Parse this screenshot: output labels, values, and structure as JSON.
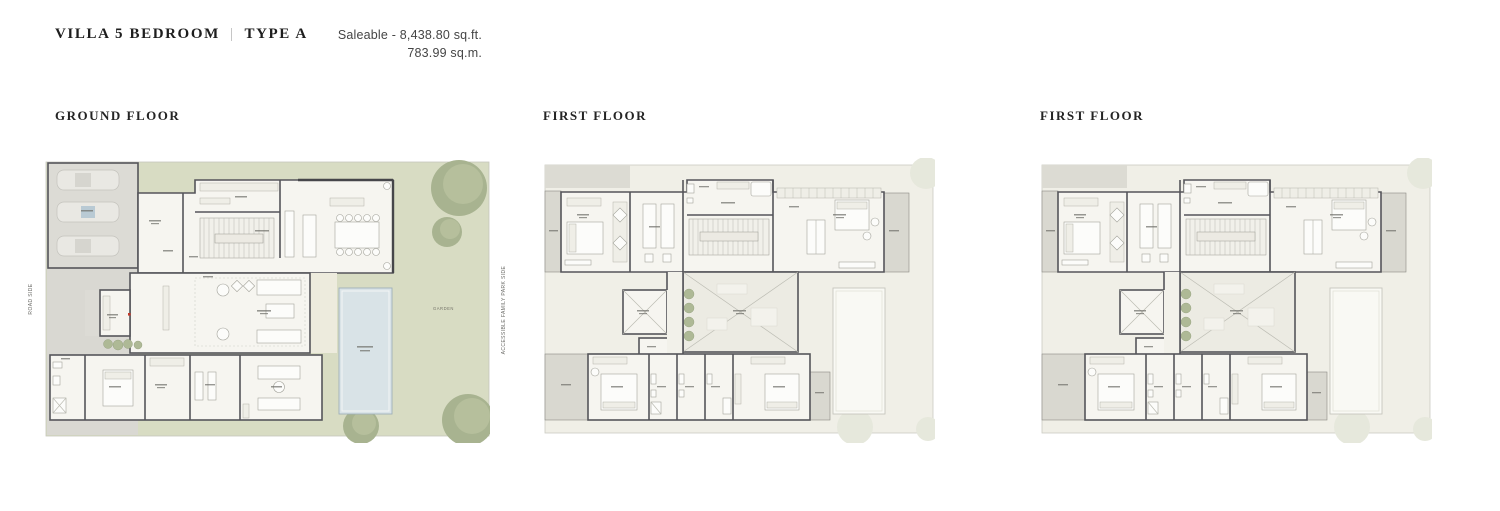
{
  "header": {
    "title": "VILLA 5 BEDROOM",
    "divider": "|",
    "variant": "TYPE A",
    "saleable_sqft": "Saleable - 8,438.80 sq.ft.",
    "saleable_sqm": "783.99 sq.m."
  },
  "plans": [
    {
      "label": "GROUND FLOOR",
      "left_side_label": "ROAD SIDE",
      "right_side_label": "ACCESSIBLE FAMILY PARK SIDE",
      "garden_label": "GARDEN"
    },
    {
      "label": "FIRST FLOOR"
    },
    {
      "label": "FIRST FLOOR"
    }
  ],
  "colors": {
    "garden_green": "#d8dcc3",
    "tree_green": "#a8b390",
    "pool_blue": "#d9e3e7",
    "wall_gray": "#55555a",
    "balcony_gray": "#d9d8d0",
    "text_dark": "#1e1e1e"
  }
}
